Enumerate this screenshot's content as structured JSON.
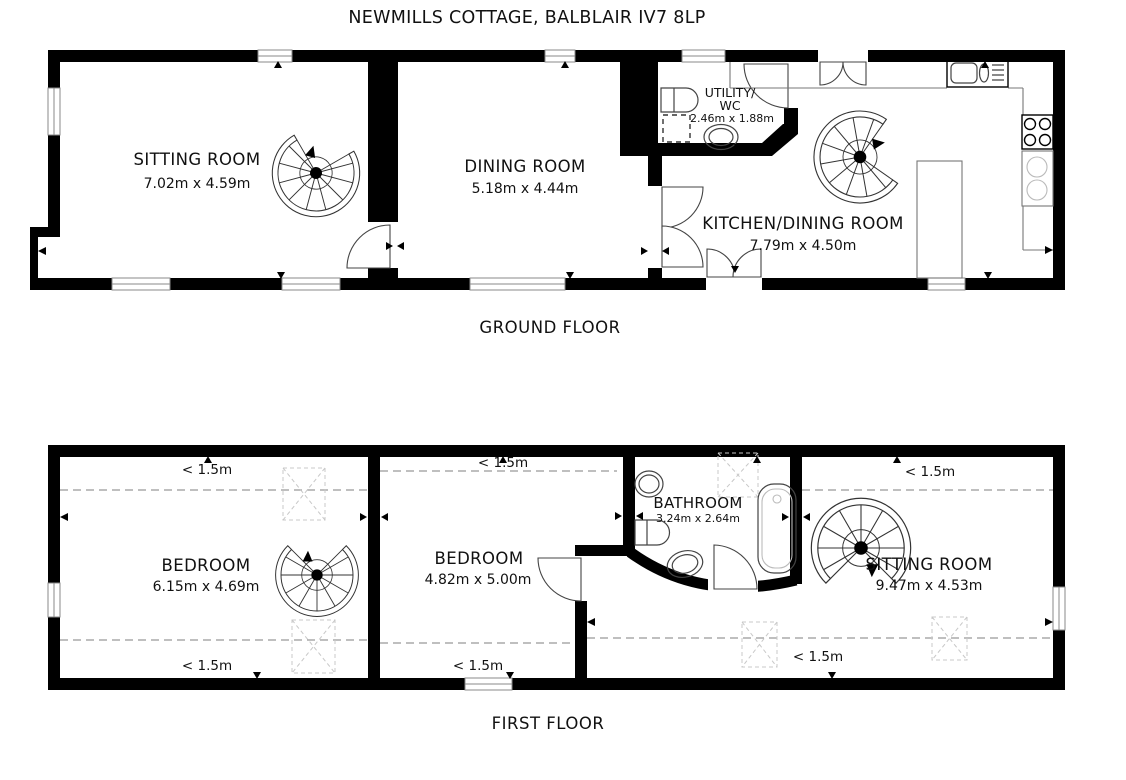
{
  "title": "NEWMILLS COTTAGE, BALBLAIR IV7 8LP",
  "ground_floor": {
    "label": "GROUND FLOOR",
    "sitting_room": {
      "name": "SITTING ROOM",
      "dims": "7.02m x 4.59m"
    },
    "dining_room": {
      "name": "DINING ROOM",
      "dims": "5.18m x 4.44m"
    },
    "utility_wc": {
      "name_line1": "UTILITY/",
      "name_line2": "WC",
      "dims": "2.46m x 1.88m"
    },
    "kitchen_dining_room": {
      "name": "KITCHEN/DINING ROOM",
      "dims": "7.79m x 4.50m"
    }
  },
  "first_floor": {
    "label": "FIRST FLOOR",
    "bedroom_1": {
      "name": "BEDROOM",
      "dims": "6.15m x 4.69m"
    },
    "bedroom_2": {
      "name": "BEDROOM",
      "dims": "4.82m x 5.00m"
    },
    "bathroom": {
      "name": "BATHROOM",
      "dims": "3.24m x 2.64m"
    },
    "sitting_room": {
      "name": "SITTING ROOM",
      "dims": "9.47m x 4.53m"
    },
    "height_restriction": "< 1.5m"
  },
  "colors": {
    "wall": "#000000",
    "background": "#ffffff",
    "dashed_restriction_line": "#999999",
    "fixture_stroke": "#444444",
    "skylight_dash": "#c8c8c8"
  }
}
